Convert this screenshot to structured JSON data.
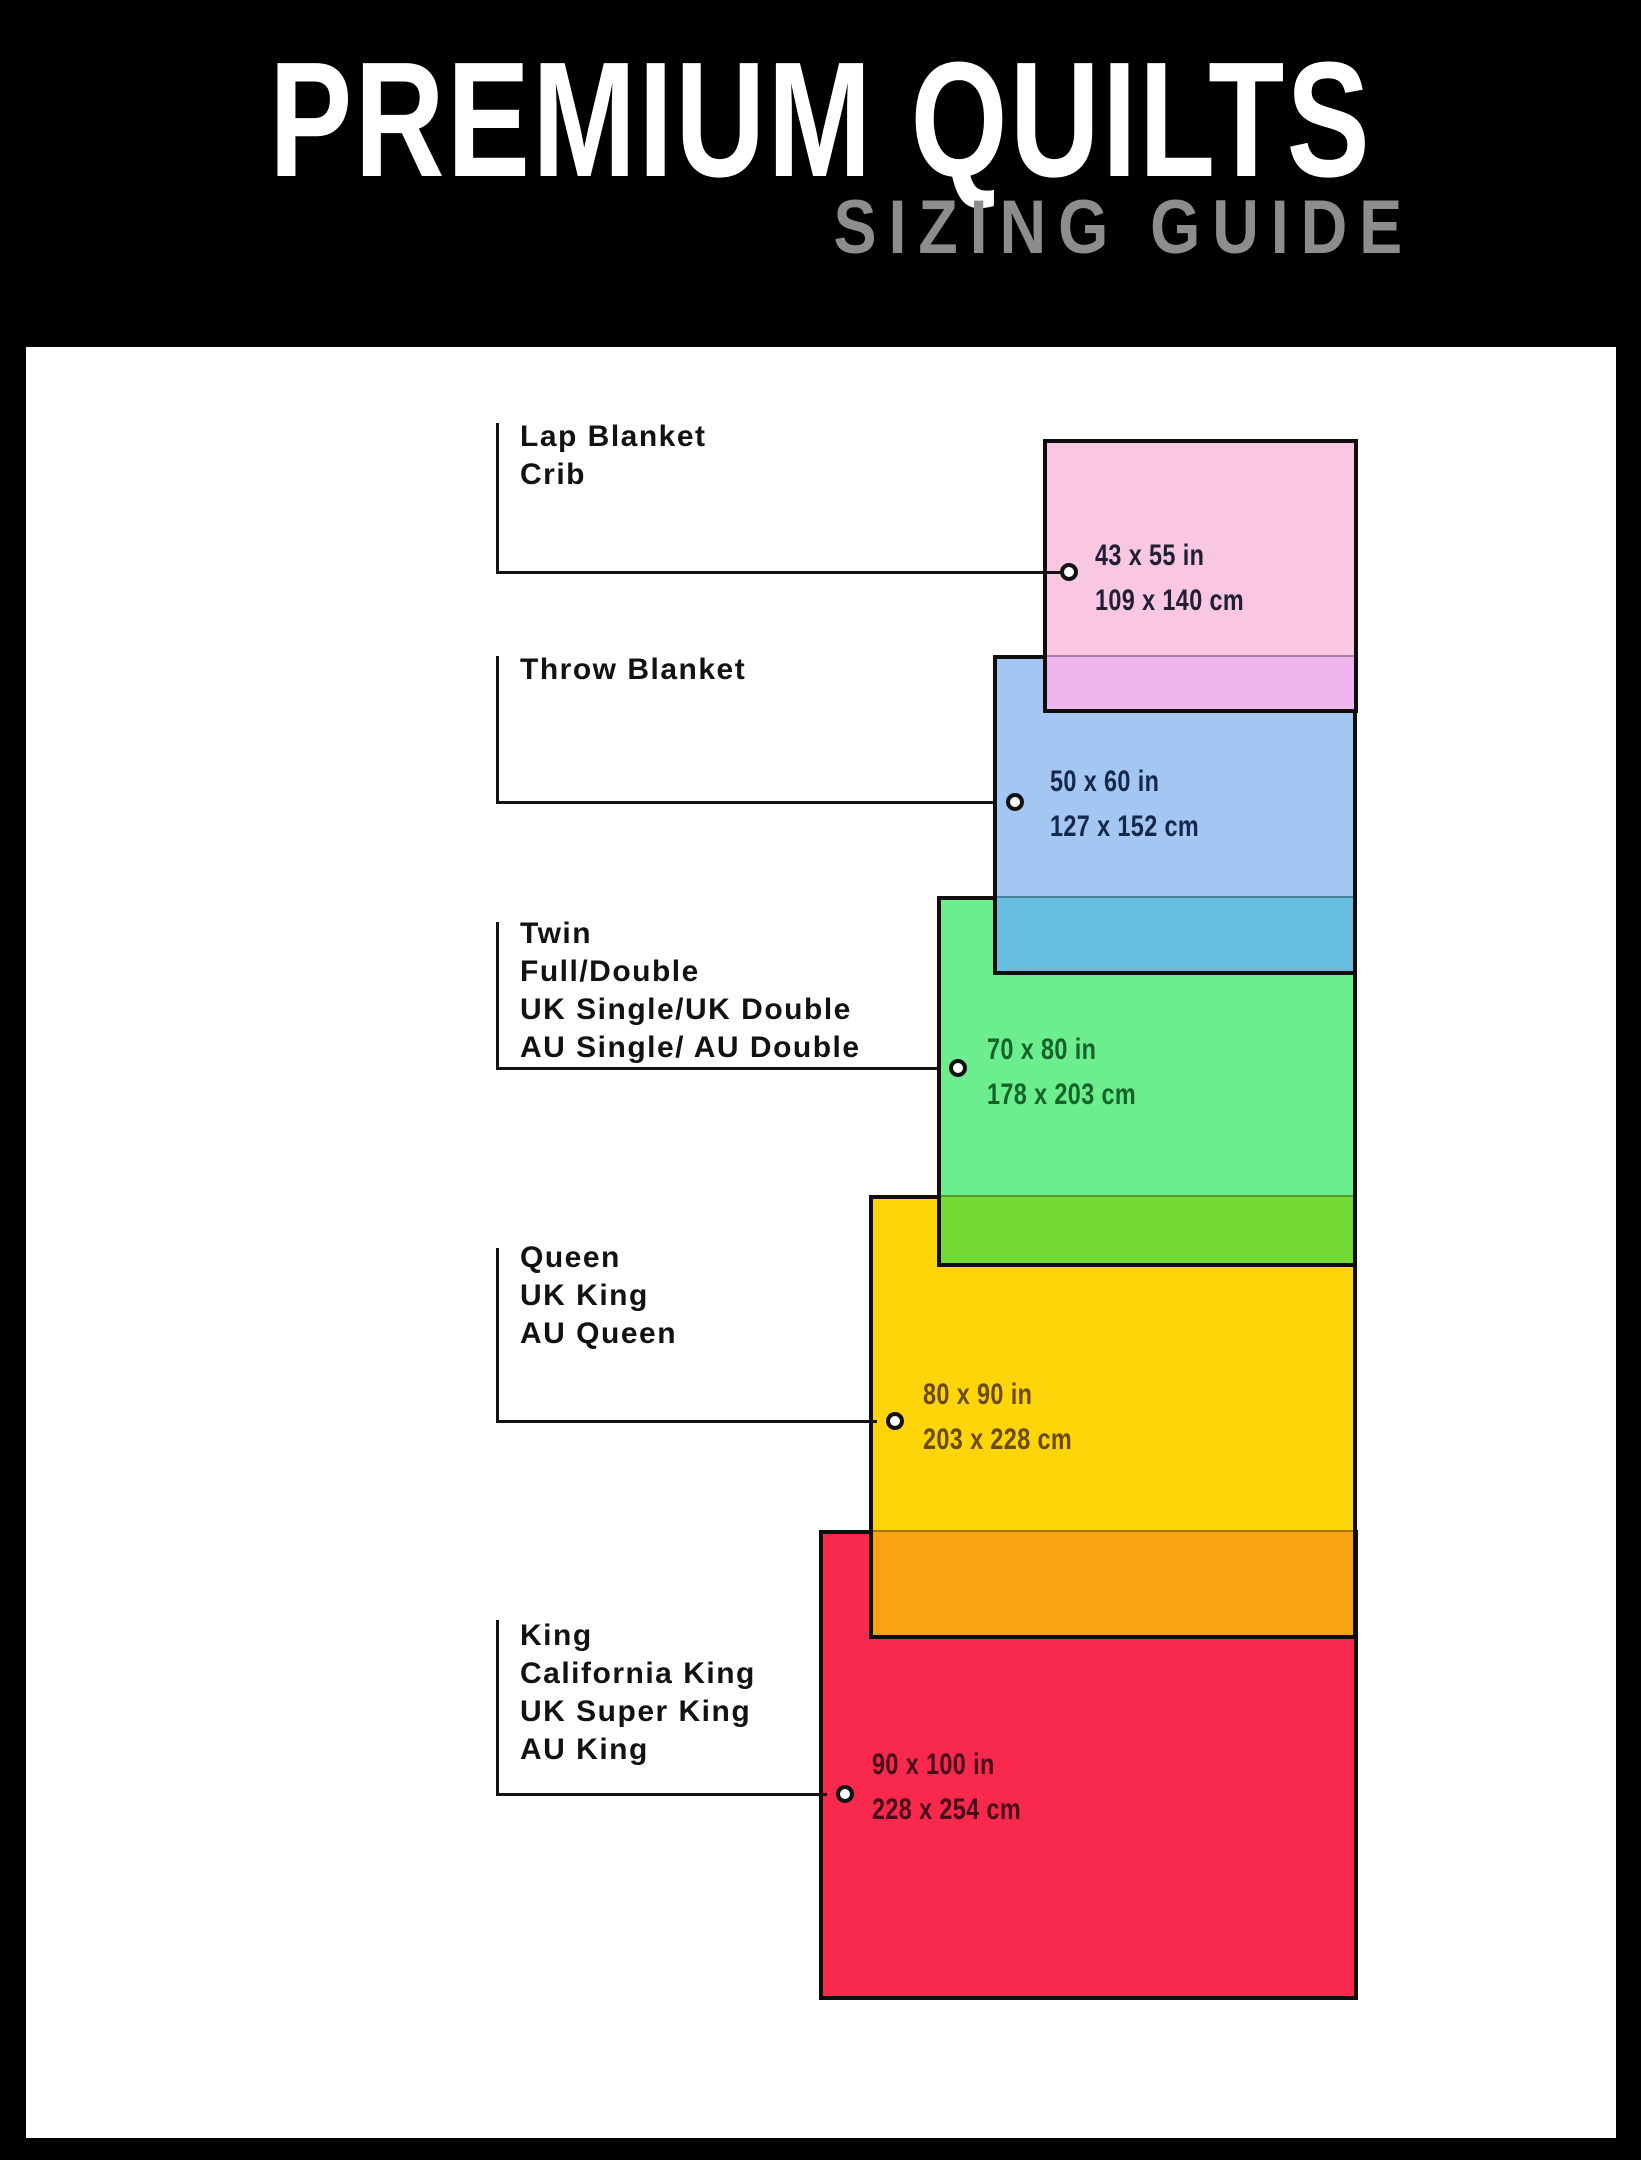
{
  "header": {
    "title": "PREMIUM QUILTS",
    "subtitle": "SIZING GUIDE"
  },
  "colors": {
    "page_bg": "#000000",
    "canvas_bg": "#FFFFFF",
    "title": "#FFFFFF",
    "subtitle": "#8D8D8D",
    "ink": "#121212"
  },
  "sizes": [
    {
      "name": "lap-blanket-crib",
      "labels": [
        "Lap Blanket",
        "Crib"
      ],
      "inches": "43 x 55 in",
      "cm": "109 x 140 cm",
      "fill": "#F9C7E2",
      "overlap_fill": "#EEB6EC",
      "text_color": "#201F35"
    },
    {
      "name": "throw-blanket",
      "labels": [
        "Throw Blanket"
      ],
      "inches": "50 x 60 in",
      "cm": "127 x 152 cm",
      "fill": "#A4C6F3",
      "overlap_fill": "#67BEDF",
      "text_color": "#14284B"
    },
    {
      "name": "twin-full-double",
      "labels": [
        "Twin",
        "Full/Double",
        "UK Single/UK Double",
        "AU Single/ AU Double"
      ],
      "inches": "70 x 80 in",
      "cm": "178 x 203 cm",
      "fill": "#6DEE8E",
      "overlap_fill": "#74DB36",
      "text_color": "#14632B"
    },
    {
      "name": "queen-uk-king-au-queen",
      "labels": [
        "Queen",
        "UK King",
        "AU Queen"
      ],
      "inches": "80 x 90 in",
      "cm": "203 x 228 cm",
      "fill": "#FDD508",
      "overlap_fill": "#F7A312",
      "text_color": "#6B4A07"
    },
    {
      "name": "king-california-king",
      "labels": [
        "King",
        "California King",
        "UK Super King",
        "AU King"
      ],
      "inches": "90 x 100 in",
      "cm": "228 x 254 cm",
      "fill": "#F9294D",
      "text_color": "#47091A"
    }
  ]
}
